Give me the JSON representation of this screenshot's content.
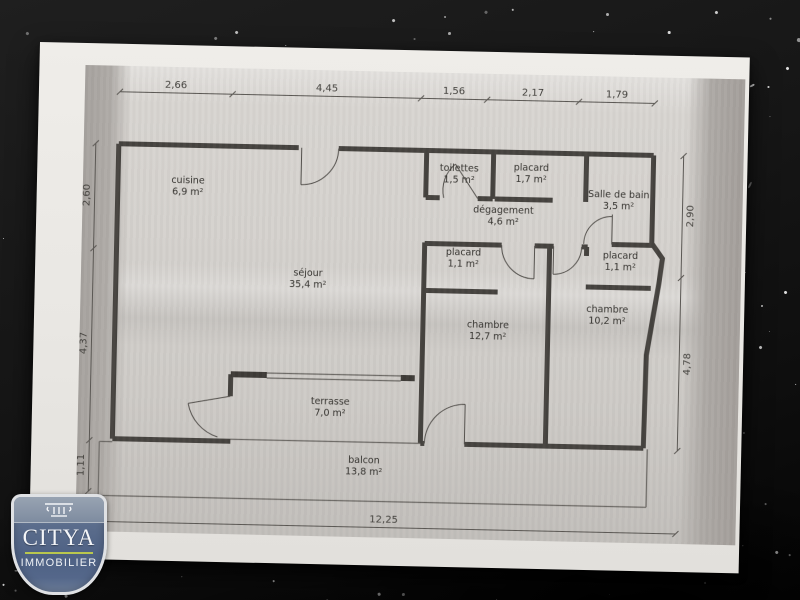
{
  "photo": {
    "surface": "black speckled granite countertop",
    "background_color": "#161616",
    "speckle_color": "#ffffff"
  },
  "paper": {
    "color": "#e9e7e3",
    "printed_tone": "#d5d2ce",
    "scan_band_color": "#a7a39f",
    "line_color": "#46433f"
  },
  "logo": {
    "brand": "CITYA",
    "tagline": "IMMOBILIER",
    "badge_color": "#4e6184",
    "badge_top_color": "#8d99aa",
    "divider_color": "#b9c74e",
    "icon": "column-capital-icon"
  },
  "plan": {
    "rooms": [
      {
        "id": "cuisine",
        "name": "cuisine",
        "area": "6,9 m²",
        "x": 115,
        "y": 138
      },
      {
        "id": "sejour",
        "name": "séjour",
        "area": "35,4 m²",
        "x": 237,
        "y": 228
      },
      {
        "id": "toilettes",
        "name": "toilettes",
        "area": "1,5 m²",
        "x": 386,
        "y": 120
      },
      {
        "id": "placard-entree",
        "name": "placard",
        "area": "1,7 m²",
        "x": 458,
        "y": 118
      },
      {
        "id": "degagement",
        "name": "dégagement",
        "area": "4,6 m²",
        "x": 431,
        "y": 161
      },
      {
        "id": "salle-de-bain",
        "name": "Salle de bain",
        "area": "3,5 m²",
        "x": 546,
        "y": 143
      },
      {
        "id": "placard-chambre1",
        "name": "placard",
        "area": "1,1 m²",
        "x": 392,
        "y": 204
      },
      {
        "id": "placard-chambre2",
        "name": "placard",
        "area": "1,1 m²",
        "x": 549,
        "y": 204
      },
      {
        "id": "chambre1",
        "name": "chambre",
        "area": "12,7 m²",
        "x": 418,
        "y": 276
      },
      {
        "id": "chambre2",
        "name": "chambre",
        "area": "10,2 m²",
        "x": 537,
        "y": 258
      },
      {
        "id": "terrasse",
        "name": "terrasse",
        "area": "7,0 m²",
        "x": 262,
        "y": 356
      },
      {
        "id": "balcon",
        "name": "balcon",
        "area": "13,8 m²",
        "x": 297,
        "y": 414
      }
    ],
    "dimensions_top": [
      {
        "label": "2,66",
        "x": 101
      },
      {
        "label": "4,45",
        "x": 252
      },
      {
        "label": "1,56",
        "x": 379
      },
      {
        "label": "2,17",
        "x": 458
      },
      {
        "label": "1,79",
        "x": 542
      }
    ],
    "dimensions_left": [
      {
        "label": "2,60",
        "y": 152
      },
      {
        "label": "4,37",
        "y": 300
      },
      {
        "label": "1,11",
        "y": 422
      }
    ],
    "dimensions_right": [
      {
        "label": "2,90",
        "y": 160
      },
      {
        "label": "4,78",
        "y": 308
      }
    ],
    "dimensions_bottom": [
      {
        "label": "12,25",
        "x": 318
      }
    ]
  }
}
